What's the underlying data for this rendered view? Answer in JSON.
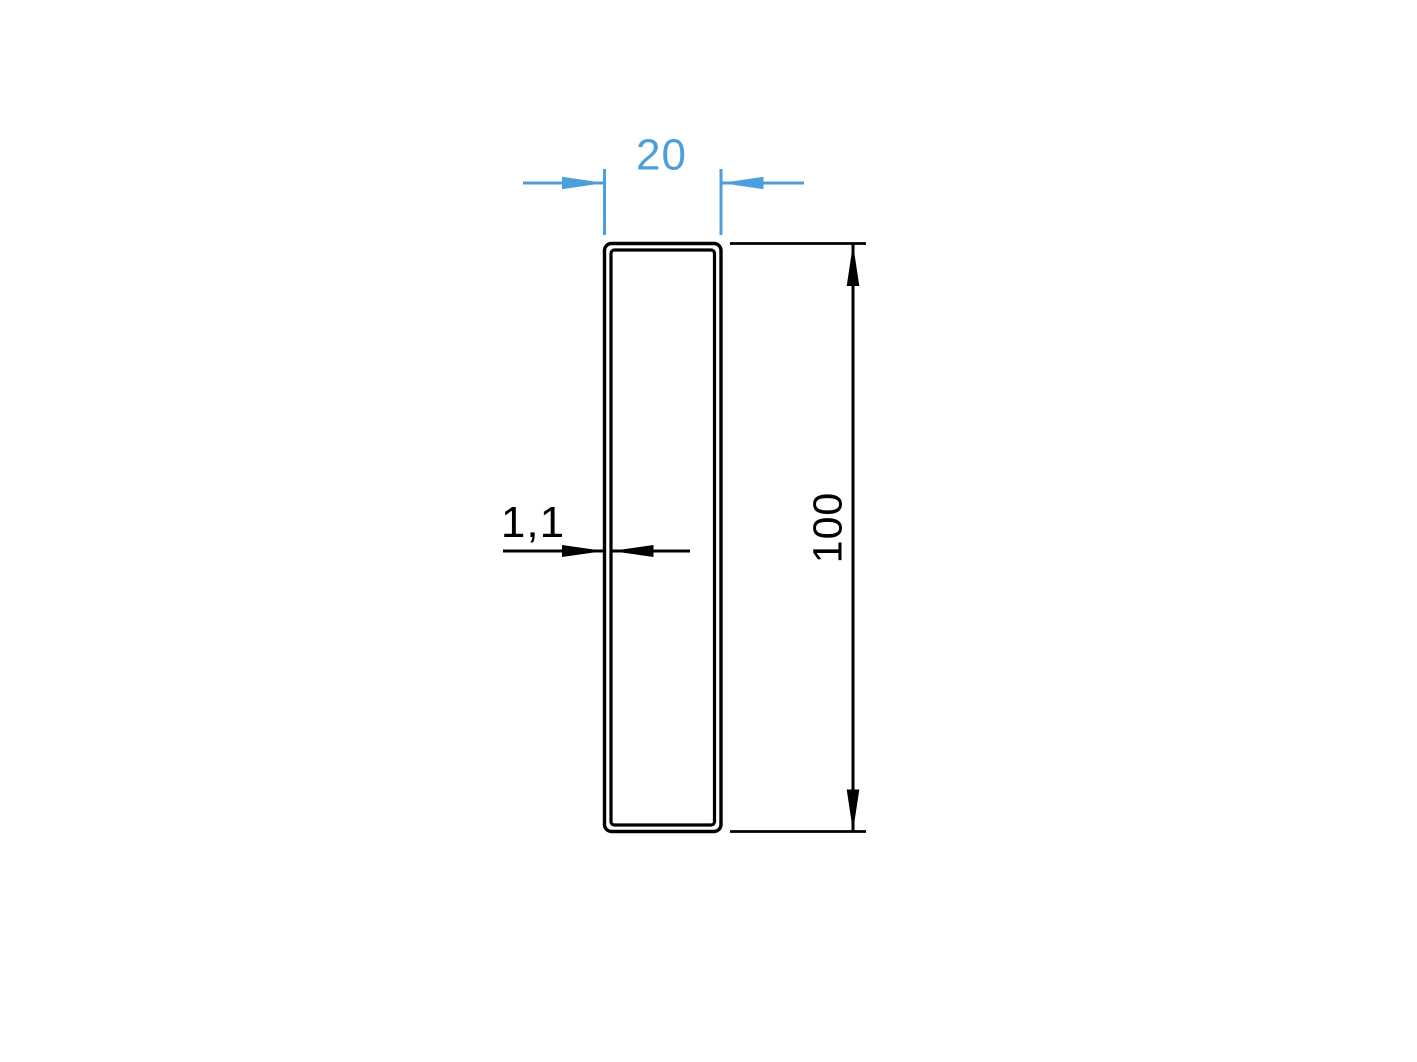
{
  "drawing": {
    "name": "rectangular-tube-profile-cross-section",
    "background_color": "#ffffff",
    "line_color": "#000000",
    "accent_color": "#4b9fdb",
    "dimensions": {
      "width": {
        "value": "20",
        "unit": ""
      },
      "height": {
        "value": "100",
        "unit": ""
      },
      "wall_thickness": {
        "value": "1,1",
        "unit": ""
      }
    }
  }
}
